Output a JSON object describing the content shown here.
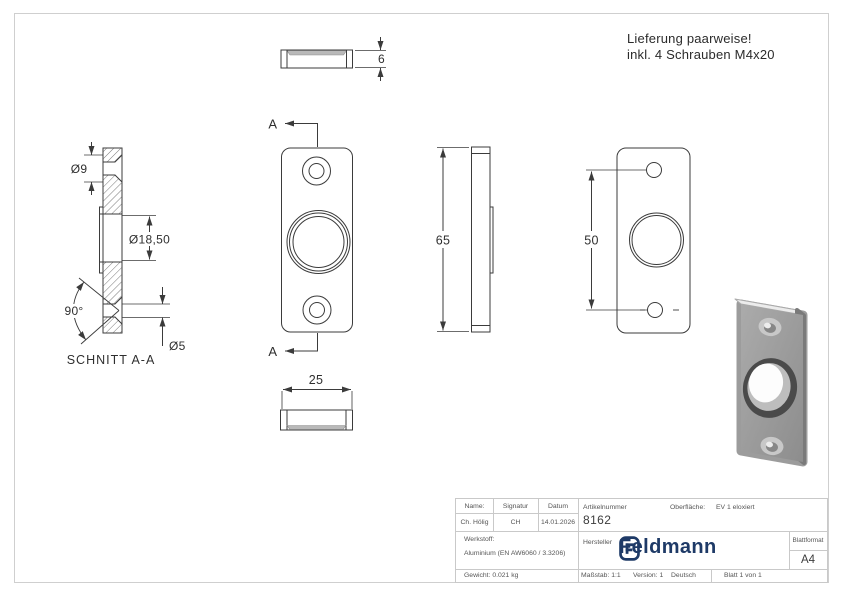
{
  "note": {
    "line1": "Lieferung paarweise!",
    "line2": "inkl. 4 Schrauben M4x20"
  },
  "dimensions": {
    "thickness": "6",
    "plate_width": "25",
    "plate_height": "65",
    "hole_spacing": "50",
    "countersink_dia": "Ø9",
    "center_hole_dia": "Ø18,50",
    "countersink_angle": "90°",
    "bore_dia": "Ø5"
  },
  "labels": {
    "section_title": "SCHNITT A-A",
    "cut_mark_top": "A",
    "cut_mark_bottom": "A"
  },
  "title_block": {
    "name_label": "Name:",
    "signature_label": "Signatur",
    "date_label": "Datum",
    "name_value": "Ch. Hölig",
    "signature_value": "CH",
    "date_value": "14.01.2026",
    "material_label": "Werkstoff:",
    "material_value": "Aluminium (EN AW6060 / 3.3206)",
    "weight": "Gewicht: 0.021 kg",
    "article_label": "Artikelnummer",
    "article_number": "8162",
    "surface_label": "Oberfläche:",
    "surface_value": "EV 1 eloxiert",
    "manufacturer_label": "Hersteller",
    "logo_text": "Feldmann",
    "sheet_format_label": "Blattformat",
    "sheet_format_value": "A4",
    "scale": "Maßstab: 1:1",
    "version": "Version: 1",
    "language": "Deutsch",
    "sheet": "Blatt 1 von 1"
  },
  "colors": {
    "line": "#3b3b3b",
    "table_border": "#c9c9c9",
    "logo_navy": "#1e3a67",
    "chamfer_gray": "#b9b9b9"
  }
}
